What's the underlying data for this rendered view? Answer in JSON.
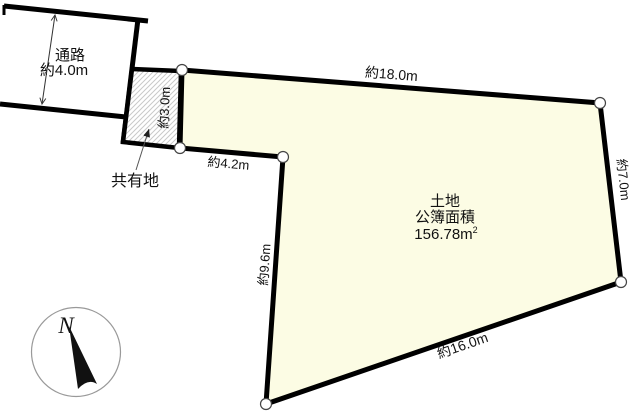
{
  "colors": {
    "plot_fill": "#FCFCE4",
    "hatch_line": "#c9c9c9",
    "outline": "#000000"
  },
  "passage": {
    "name_label": "通路",
    "width_label": "約4.0m"
  },
  "shared_area": {
    "name_label": "共有地",
    "width_label": "約3.0m"
  },
  "plot": {
    "title": "土地",
    "subtitle": "公簿面積",
    "area_value": "156.78m",
    "area_superscript": "2",
    "dimensions": {
      "top_edge": "約18.0m",
      "right_edge": "約7.0m",
      "bottom_edge": "約16.0m",
      "left_edge": "約9.6m",
      "notch_edge": "約4.2m"
    }
  },
  "compass": {
    "north_label": "N"
  }
}
